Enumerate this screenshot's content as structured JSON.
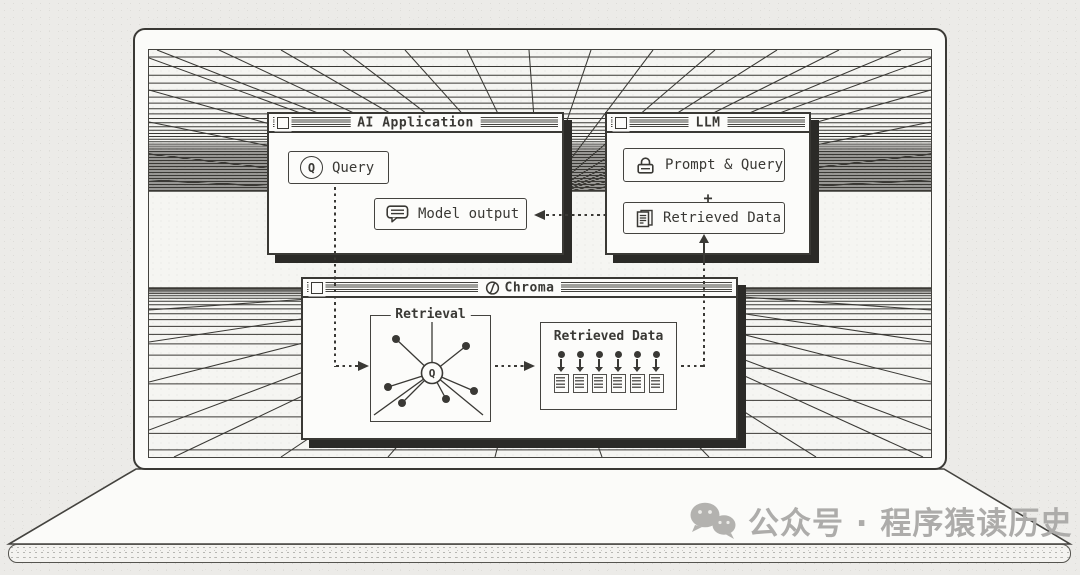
{
  "colors": {
    "ink": "#3a3935",
    "paper": "#fcfcfa",
    "shadow": "#2b2a27",
    "screen_bg": "#f5f5f2",
    "page_bg": "#ecebe8",
    "watermark": "#adacaa"
  },
  "windows": {
    "ai_application": {
      "title": "AI Application",
      "query_button": {
        "icon": "q-circle-icon",
        "label": "Query"
      },
      "model_output_button": {
        "icon": "speech-bubble-icon",
        "label": "Model output"
      }
    },
    "llm": {
      "title": "LLM",
      "prompt_query_button": {
        "icon": "prompt-lock-icon",
        "label": "Prompt & Query"
      },
      "plus": "+",
      "retrieved_data_button": {
        "icon": "document-icon",
        "label": "Retrieved Data"
      }
    },
    "chroma": {
      "title": "Chroma",
      "logo": "chroma-logo-icon",
      "retrieval_box": {
        "label": "Retrieval",
        "center_node": "Q",
        "node_count": 6
      },
      "retrieved_data_box": {
        "label": "Retrieved Data",
        "doc_count": 6
      }
    }
  },
  "watermark": {
    "icon": "wechat-icon",
    "text": "公众号 · 程序猿读历史"
  }
}
